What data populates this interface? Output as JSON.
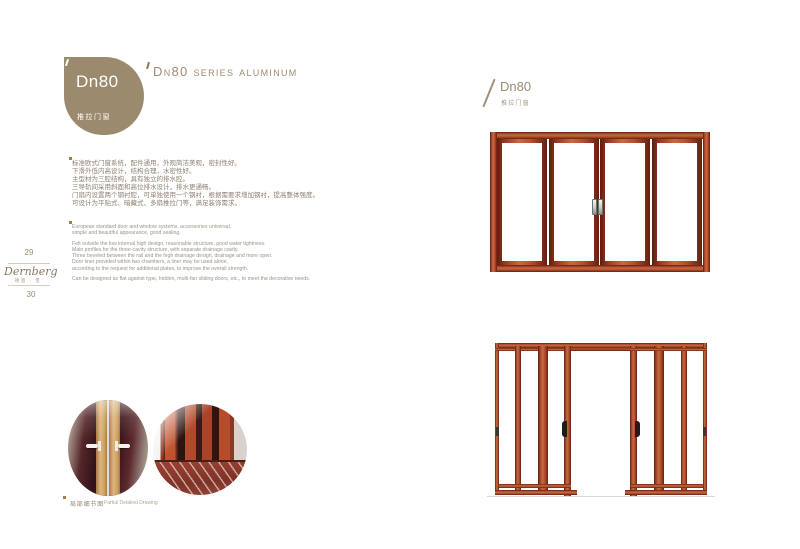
{
  "colors": {
    "badge_brown": "#9c8a6e",
    "accent_text": "#a18a71",
    "bullet_orange": "#a97b42",
    "wood_light": "#c66a41",
    "wood_dark": "#5e1d0e",
    "cn_text": "#8d8072",
    "en_text": "#9b948a"
  },
  "badge": {
    "model": "Dn80",
    "type": "推拉门窗"
  },
  "header": {
    "title": "Dn80 series aluminum"
  },
  "intro_cn": {
    "lines": [
      "标准欧式门窗系统，配件通用，外观简洁美观，密封性好。",
      "下滑外低内高设计，结构合理，水密性好。",
      "主型材为三腔结构，具有独立的排水腔。",
      "三导轨间采用斜面和高位排水设计，排水更通畅。",
      "门扇内设置两个钢衬腔，可单独使用一个钢衬，根据需要求增加钢衬，提高整体强度。",
      "可设计为平贴式、暗藏式、多扇推拉门等，满足装饰需求。"
    ]
  },
  "intro_en": {
    "block1": [
      "European standard door and window systems, accessories universal,",
      "simple and beautiful appearance, good sealing."
    ],
    "block2": [
      "Felt outside the low internal high design, reasonable structure, good water tightness.",
      "Main profiles for the three-cavity structure, with separate drainage cavity.",
      "Three beveled between the rail and the high drainage design, drainage and more open.",
      "Door liner provided within two chambers, a liner may be used alone,",
      "according to the request for additional plates, to improve the overall strength."
    ],
    "block3": [
      "Can be designed as flat against type, hidden, multi-fan sliding doors, etc., to meet the decorative needs."
    ]
  },
  "sidebar": {
    "page_top": "29",
    "brand": "Dernberg",
    "brand_sub": "德恩 · 堡",
    "page_bottom": "30"
  },
  "right_header": {
    "model": "Dn80",
    "type": "推拉门窗"
  },
  "caption": {
    "cn": "局部细节图",
    "en": "Partial Detailed Drawing"
  }
}
